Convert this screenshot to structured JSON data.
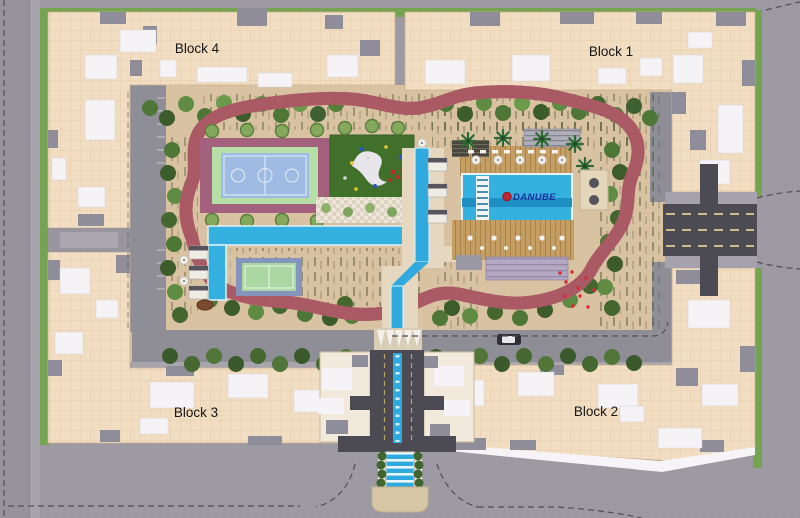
{
  "plan": {
    "brand_label": "DANUBE",
    "blocks": [
      {
        "name": "block-4",
        "label": "Block 4"
      },
      {
        "name": "block-1",
        "label": "Block 1"
      },
      {
        "name": "block-3",
        "label": "Block 3"
      },
      {
        "name": "block-2",
        "label": "Block 2"
      }
    ],
    "features": [
      "jogging-track",
      "basketball-court",
      "padel-court",
      "kids-playground",
      "lap-pool",
      "leisure-pool",
      "water-channel",
      "pool-deck",
      "sunken-seating",
      "pool-bar",
      "cabanas",
      "entrance-water-cascade",
      "south-entrance",
      "east-entrance",
      "internal-road",
      "tree-row",
      "perimeter-green",
      "parking-lane"
    ],
    "colors": {
      "road_gray": "#9d9aa4",
      "asphalt_dark": "#4c4b53",
      "building_beige": "#f1ddc1",
      "roof_white": "#f5f3f6",
      "roof_gray": "#8e8d99",
      "green_strip": "#76a351",
      "lawn_green": "#41702b",
      "track_pink": "#e3a3ac",
      "track_edge": "#aa5a64",
      "pool_blue": "#35b1e0",
      "court_blue": "#9fbbe4",
      "court_pad_maroon": "#a4617e",
      "padel_green": "#abd8a2",
      "deck_wood": "#c59e63",
      "ground_beige": "#d8c2a2",
      "brand_blue": "#1c2e9e",
      "brand_red": "#c32432"
    }
  }
}
